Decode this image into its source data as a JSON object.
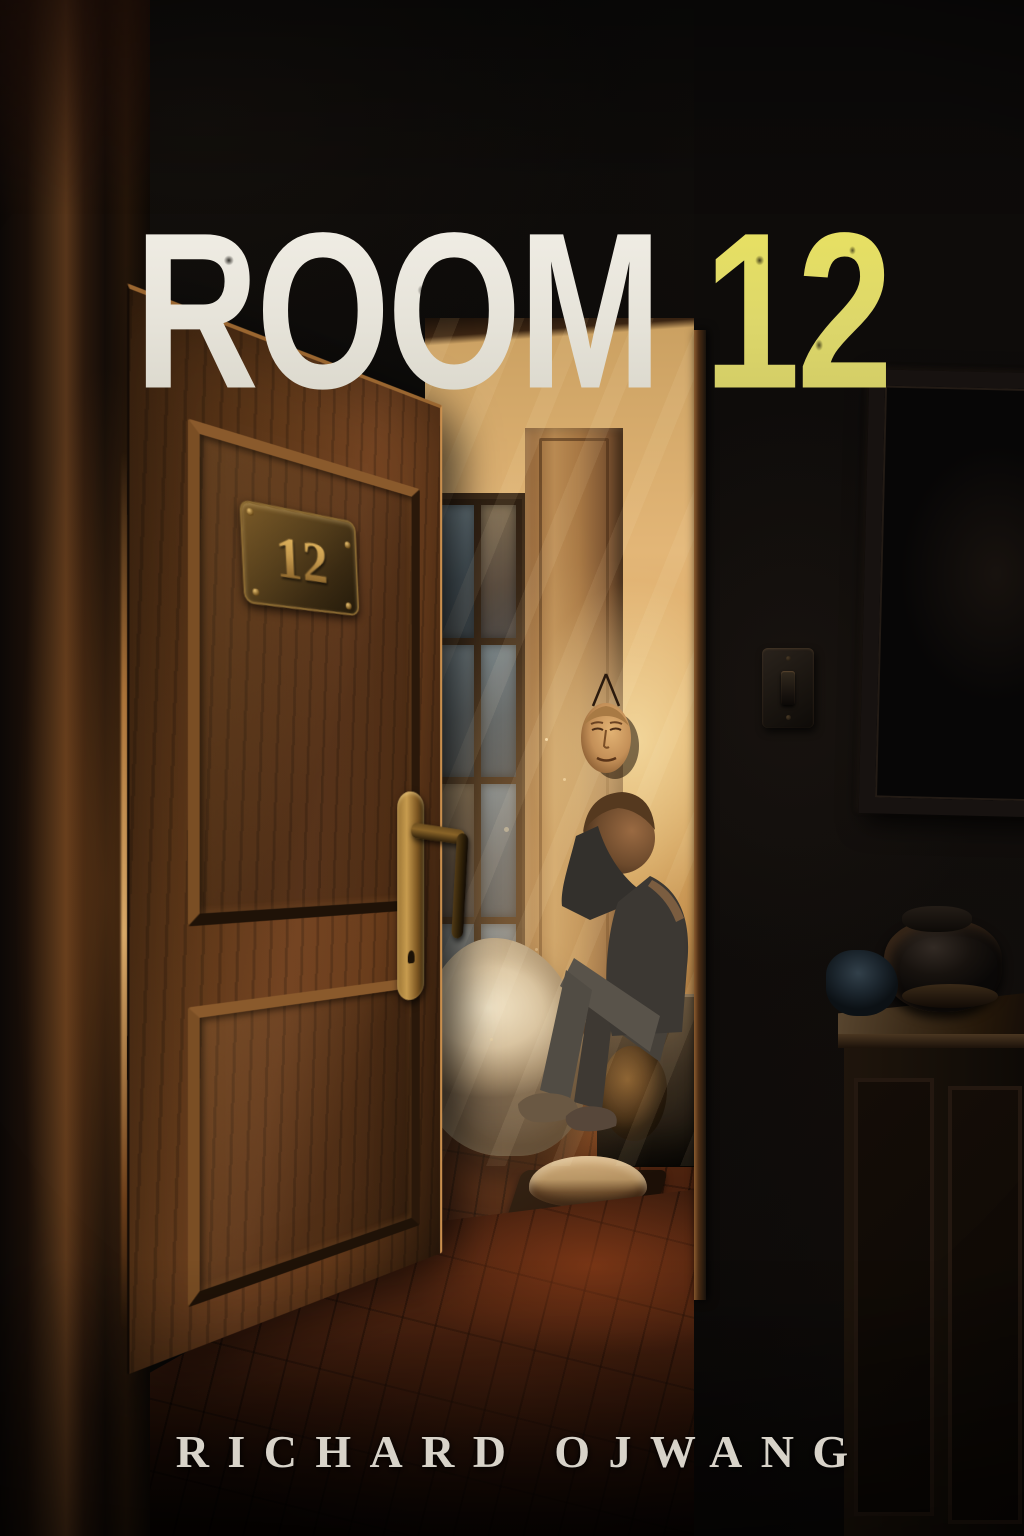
{
  "cover": {
    "title": {
      "word": "ROOM",
      "number": "12"
    },
    "author": "RICHARD OJWANG",
    "door_plate_number": "12"
  },
  "colors": {
    "background": "#0b0a09",
    "title_white": "#ece9de",
    "title_yellow": "#ddd76a",
    "author_text": "#d8d3c9",
    "door_wood": "#6a3d1c",
    "brass": "#c79b4e",
    "interior_glow": "#edb269",
    "window_pane_blue": "#5a6a72",
    "floor_brown": "#46200e"
  }
}
